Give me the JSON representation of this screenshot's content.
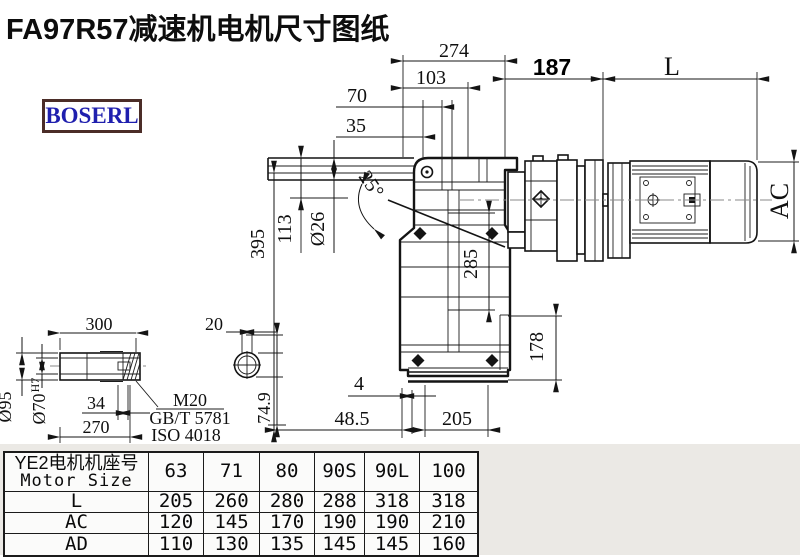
{
  "title": "FA97R57减速机电机尺寸图纸",
  "logo": "BOSERL",
  "dims": {
    "d274": "274",
    "d103": "103",
    "d70": "70",
    "d35": "35",
    "d187": "187",
    "dL": "L",
    "dAC": "AC",
    "d395": "395",
    "d113": "113",
    "d26": "Ø26",
    "angle": "25°",
    "d285": "285",
    "d178": "178",
    "d4": "4",
    "d485": "48.5",
    "d205": "205",
    "d300": "300",
    "d20": "20",
    "d95": "Ø95",
    "d70h7": "Ø70",
    "d70h7_sup": "H7",
    "d34": "34",
    "d270": "270",
    "d749": "74.9",
    "m20": "M20",
    "gbt": "GB/T 5781",
    "iso": "ISO 4018"
  },
  "table": {
    "header_cn": "YE2电机机座号",
    "header_en": "Motor Size",
    "columns": [
      "63",
      "71",
      "80",
      "90S",
      "90L",
      "100"
    ],
    "rows": [
      {
        "label": "L",
        "values": [
          "205",
          "260",
          "280",
          "288",
          "318",
          "318"
        ]
      },
      {
        "label": "AC",
        "values": [
          "120",
          "145",
          "170",
          "190",
          "190",
          "210"
        ]
      },
      {
        "label": "AD",
        "values": [
          "110",
          "130",
          "135",
          "145",
          "145",
          "160"
        ]
      }
    ]
  }
}
